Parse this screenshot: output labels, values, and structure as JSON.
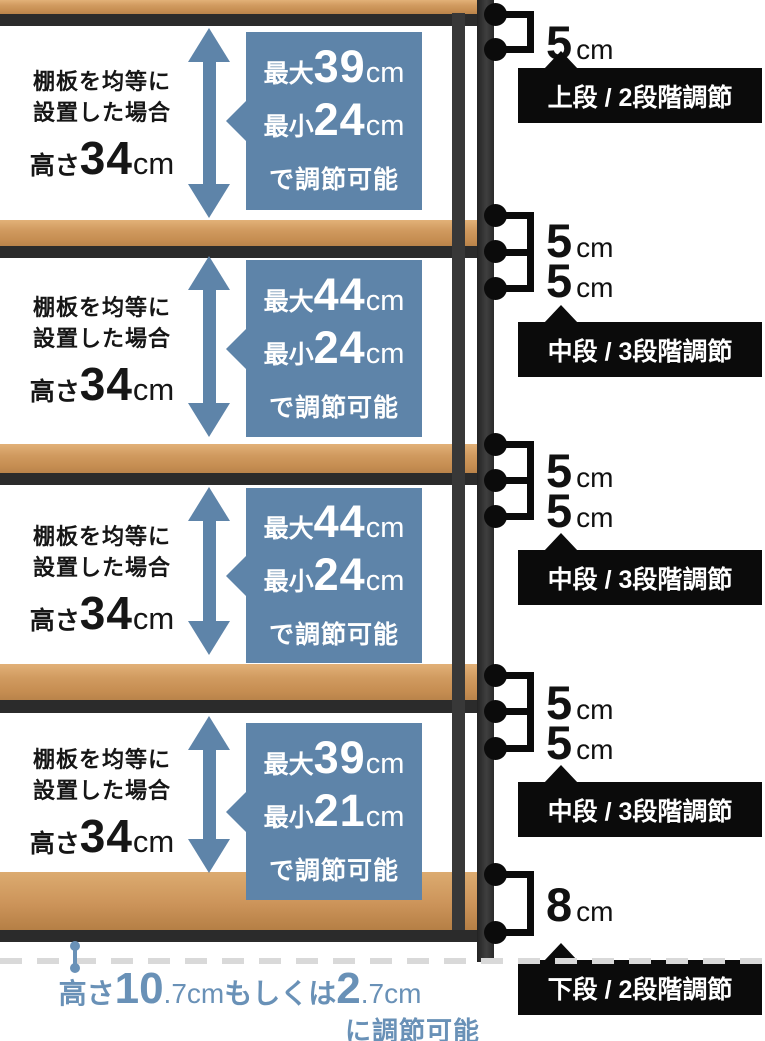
{
  "colors": {
    "accent_blue": "#5e84a9",
    "label_black": "#0b0b0b",
    "floor_blue": "#6991b7",
    "wood": "#c68e52",
    "frame": "#2b2b2b"
  },
  "sections": [
    {
      "cap1": "棚板を均等に",
      "cap2": "設置した場合",
      "h_label": "高さ",
      "h_value": "34",
      "h_unit": "cm",
      "max_label": "最大",
      "max_value": "39",
      "max_unit": "cm",
      "min_label": "最小",
      "min_value": "24",
      "min_unit": "cm",
      "note": "で調節可能"
    },
    {
      "cap1": "棚板を均等に",
      "cap2": "設置した場合",
      "h_label": "高さ",
      "h_value": "34",
      "h_unit": "cm",
      "max_label": "最大",
      "max_value": "44",
      "max_unit": "cm",
      "min_label": "最小",
      "min_value": "24",
      "min_unit": "cm",
      "note": "で調節可能"
    },
    {
      "cap1": "棚板を均等に",
      "cap2": "設置した場合",
      "h_label": "高さ",
      "h_value": "34",
      "h_unit": "cm",
      "max_label": "最大",
      "max_value": "44",
      "max_unit": "cm",
      "min_label": "最小",
      "min_value": "24",
      "min_unit": "cm",
      "note": "で調節可能"
    },
    {
      "cap1": "棚板を均等に",
      "cap2": "設置した場合",
      "h_label": "高さ",
      "h_value": "34",
      "h_unit": "cm",
      "max_label": "最大",
      "max_value": "39",
      "max_unit": "cm",
      "min_label": "最小",
      "min_value": "21",
      "min_unit": "cm",
      "note": "で調節可能"
    }
  ],
  "annotations": [
    {
      "label": "上段 / 2段階調節",
      "gaps": [
        {
          "value": "5",
          "unit": "cm"
        }
      ]
    },
    {
      "label": "中段 / 3段階調節",
      "gaps": [
        {
          "value": "5",
          "unit": "cm"
        },
        {
          "value": "5",
          "unit": "cm"
        }
      ]
    },
    {
      "label": "中段 / 3段階調節",
      "gaps": [
        {
          "value": "5",
          "unit": "cm"
        },
        {
          "value": "5",
          "unit": "cm"
        }
      ]
    },
    {
      "label": "中段 / 3段階調節",
      "gaps": [
        {
          "value": "5",
          "unit": "cm"
        },
        {
          "value": "5",
          "unit": "cm"
        }
      ]
    },
    {
      "label": "下段 / 2段階調節",
      "gaps": [
        {
          "value": "8",
          "unit": "cm"
        }
      ]
    }
  ],
  "floor": {
    "prefix": "高さ",
    "v1": "10",
    "s1": ".7cm",
    "mid": "もしくは",
    "v2": "2",
    "s2": ".7cm",
    "note": "に調節可能"
  }
}
